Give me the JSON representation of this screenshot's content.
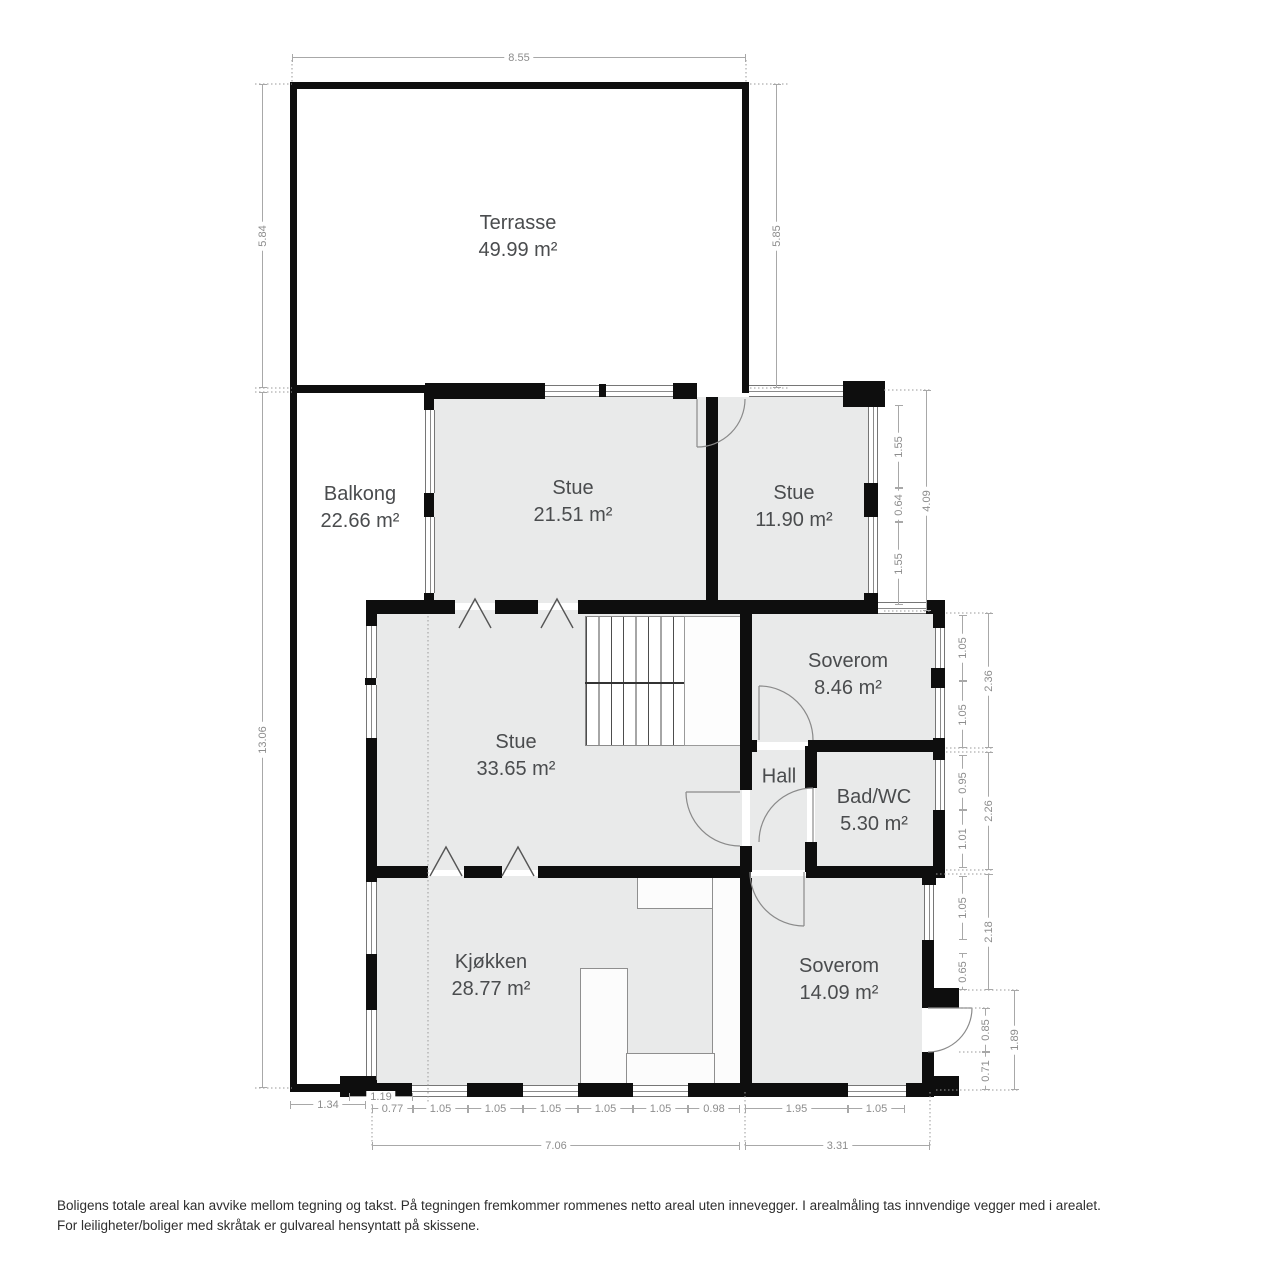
{
  "plan_title": "Floor plan",
  "rooms": {
    "terrasse": {
      "name": "Terrasse",
      "area": "49.99 m²"
    },
    "balkong": {
      "name": "Balkong",
      "area": "22.66 m²"
    },
    "stue1": {
      "name": "Stue",
      "area": "21.51 m²"
    },
    "stue2": {
      "name": "Stue",
      "area": "11.90 m²"
    },
    "soverom1": {
      "name": "Soverom",
      "area": "8.46 m²"
    },
    "stue3": {
      "name": "Stue",
      "area": "33.65 m²"
    },
    "hall": {
      "name": "Hall"
    },
    "bad": {
      "name": "Bad/WC",
      "area": "5.30 m²"
    },
    "kjokken": {
      "name": "Kjøkken",
      "area": "28.77 m²"
    },
    "soverom2": {
      "name": "Soverom",
      "area": "14.09 m²"
    }
  },
  "dims": {
    "top": "8.55",
    "terrace_left": "5.84",
    "terrace_right": "5.85",
    "left": "13.06",
    "stue2_win1": "1.55",
    "stue2_wall": "0.64",
    "stue2_win2": "1.55",
    "stue2_total": "4.09",
    "sov1_win1": "1.05",
    "sov1_win2": "1.05",
    "sov1_total": "2.36",
    "bad_win": "0.95",
    "bad_wall": "1.01",
    "bad_total": "2.26",
    "sov2_win": "1.05",
    "sov2_wall": "0.65",
    "sov2_total": "2.18",
    "door_open": "0.85",
    "door_below": "0.71",
    "door_total": "1.89",
    "b_134": "1.34",
    "b_119": "1.19",
    "b_077": "0.77",
    "b_105a": "1.05",
    "b_105b": "1.05",
    "b_105c": "1.05",
    "b_105d": "1.05",
    "b_105e": "1.05",
    "b_098": "0.98",
    "b_195": "1.95",
    "b_105f": "1.05",
    "b_706": "7.06",
    "b_331": "3.31"
  },
  "footer": {
    "line1": "Boligens totale areal kan avvike mellom tegning og takst. På tegningen fremkommer rommenes netto areal uten innevegger. I arealmåling tas innvendige vegger med i arealet.",
    "line2": "For leiligheter/boliger med skråtak er gulvareal hensyntatt på skissene."
  },
  "colors": {
    "wall": "#0e0e0e",
    "room_fill": "#e9eaea",
    "outdoor_fill": "#ffffff",
    "dim_line": "#a8a8a8",
    "dim_text": "#8d8d8d"
  }
}
